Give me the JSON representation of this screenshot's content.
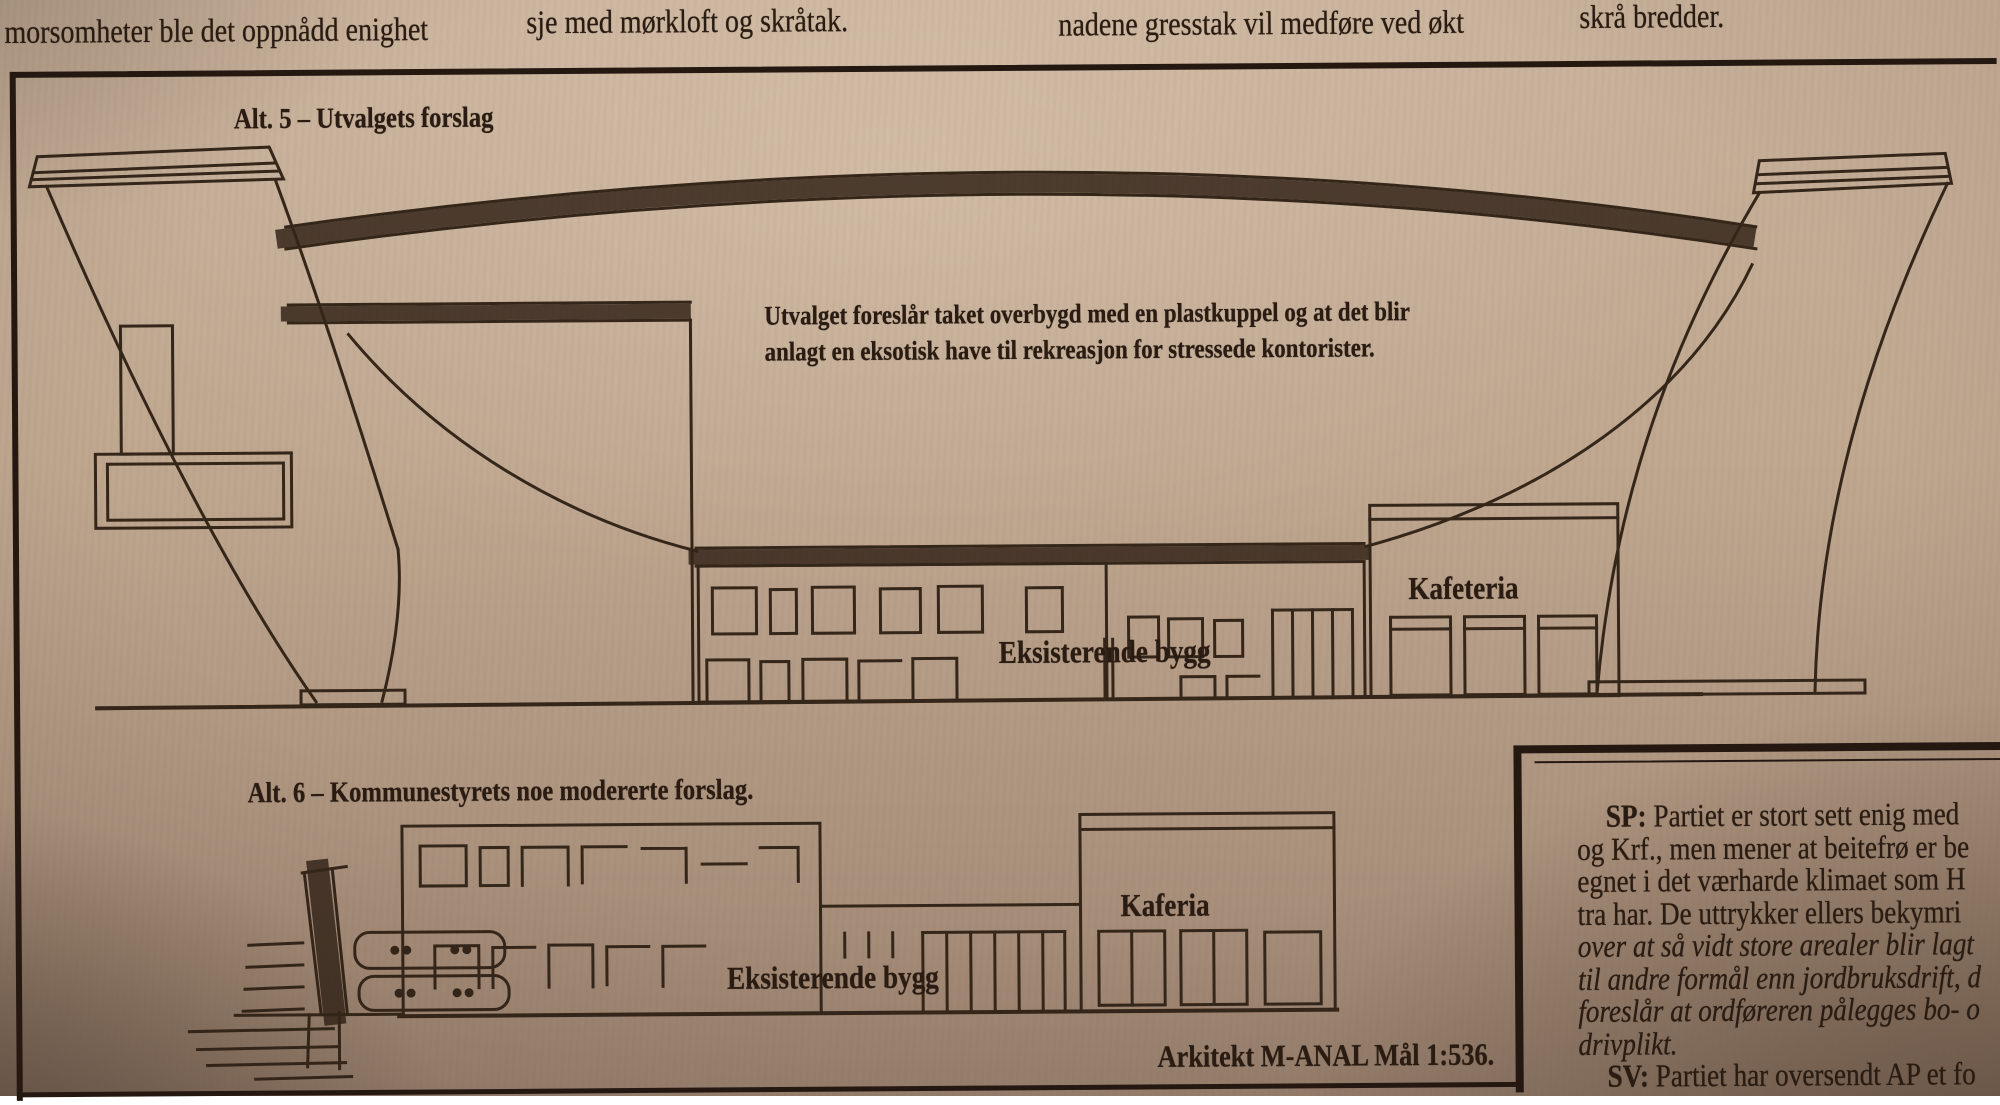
{
  "top_strip": {
    "fragments": [
      "morsomheter ble det oppnådd enighet",
      "sje med mørkloft og skråtak.",
      "nadene gresstak vil medføre ved økt",
      "skrå bredder."
    ]
  },
  "figure": {
    "alt5": {
      "title": "Alt. 5 – Utvalgets forslag",
      "annotation": [
        "Utvalget foreslår taket overbygd med en plastkuppel og at det blir",
        "anlagt en eksotisk have til rekreasjon for stressede kontorister."
      ],
      "labels": {
        "cafeteria": "Kafeteria",
        "existing_building": "Eksisterende bygg"
      }
    },
    "alt6": {
      "title": "Alt. 6 – Kommunestyrets noe modererte forslag.",
      "labels": {
        "cafeteria": "Kaferia",
        "existing_building": "Eksisterende bygg"
      },
      "caption": "Arkitekt M-ANAL Mål 1:536."
    }
  },
  "article": {
    "lines": [
      {
        "prefix": "SP:",
        "text": " Partiet er stort sett enig med"
      },
      {
        "prefix": "",
        "text": "og Krf., men mener at beitefrø er be"
      },
      {
        "prefix": "",
        "text": "egnet i det værharde klimaet som H"
      },
      {
        "prefix": "",
        "text": "tra har. De uttrykker ellers bekymri"
      },
      {
        "prefix": "",
        "text": "over at så vidt store arealer blir lagt"
      },
      {
        "prefix": "",
        "text": "til andre formål enn jordbruksdrift, d"
      },
      {
        "prefix": "",
        "text": "foreslår at ordføreren pålegges bo- o"
      },
      {
        "prefix": "",
        "text": "drivplikt."
      },
      {
        "prefix": "SV:",
        "text": " Partiet har oversendt AP et fo"
      }
    ]
  },
  "colors": {
    "paper": "#bfa790",
    "ink": "#2e2015"
  }
}
